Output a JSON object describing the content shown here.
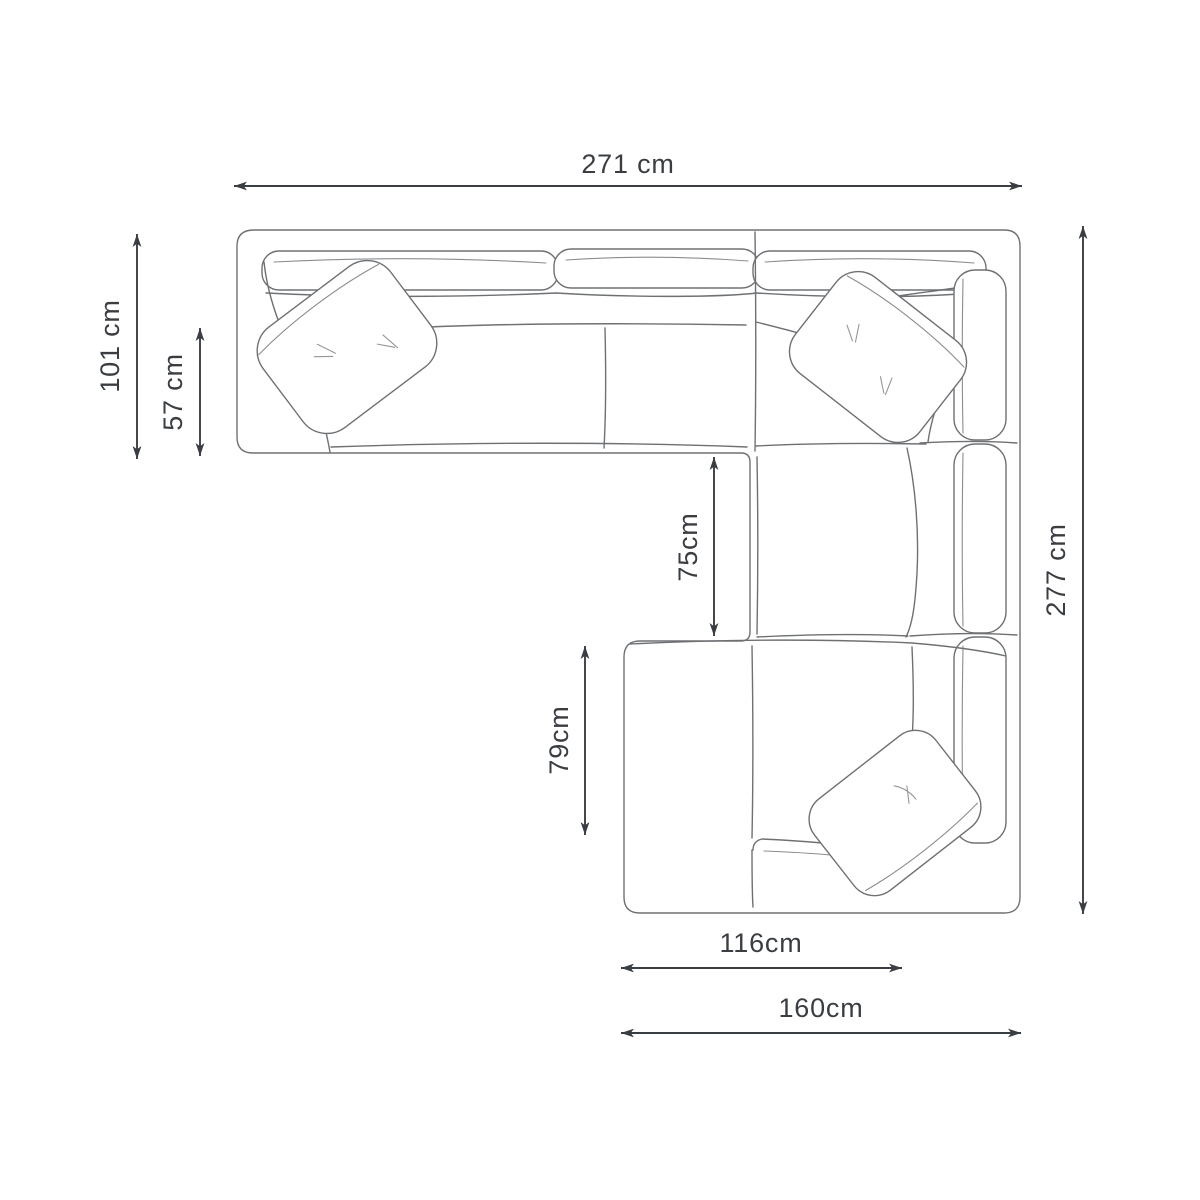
{
  "diagram": {
    "subject": "Corner sofa with chaise - top view dimension drawing",
    "unit": "cm",
    "colors": {
      "background": "#ffffff",
      "dimension_lines": "#3a3e43",
      "sofa_outline": "#6e7174"
    },
    "dimensions": {
      "total_width": {
        "label": "271 cm",
        "value": 271,
        "orientation": "horizontal",
        "position": "top"
      },
      "left_depth": {
        "label": "101 cm",
        "value": 101,
        "orientation": "vertical",
        "position": "left-outer"
      },
      "seat_depth": {
        "label": "57 cm",
        "value": 57,
        "orientation": "vertical",
        "position": "left-inner"
      },
      "inner_depth": {
        "label": "75cm",
        "value": 75,
        "orientation": "vertical",
        "position": "center"
      },
      "chaise_length": {
        "label": "79cm",
        "value": 79,
        "orientation": "vertical",
        "position": "center-lower"
      },
      "total_depth": {
        "label": "277 cm",
        "value": 277,
        "orientation": "vertical",
        "position": "right"
      },
      "chaise_width": {
        "label": "116cm",
        "value": 116,
        "orientation": "horizontal",
        "position": "bottom-inner"
      },
      "bottom_width": {
        "label": "160cm",
        "value": 160,
        "orientation": "horizontal",
        "position": "bottom-outer"
      }
    }
  }
}
